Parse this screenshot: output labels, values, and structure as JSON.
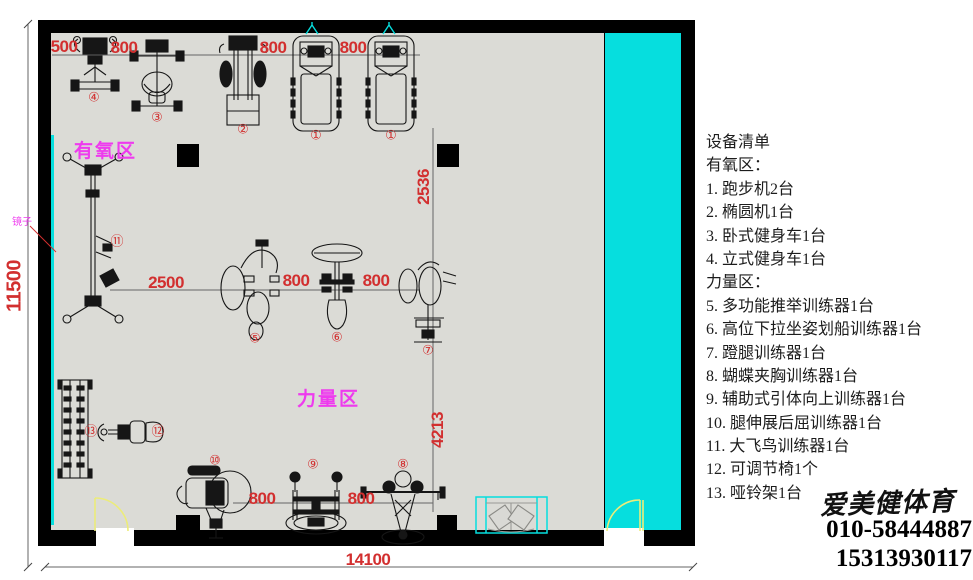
{
  "plan": {
    "zone_labels": {
      "aerobic": "有氧区",
      "strength": "力量区",
      "mirror": "镜子"
    },
    "dims": {
      "top_offset": "500",
      "top_gap1": "800",
      "top_gap2": "800",
      "top_gap3": "800",
      "mid_span": "2500",
      "mid_gap1": "800",
      "mid_gap2": "800",
      "vert_upper": "2536",
      "vert_lower": "4213",
      "bottom_gap1": "800",
      "bottom_gap2": "800",
      "total_height": "11500",
      "total_width": "14100"
    },
    "markers": {
      "m1a": "①",
      "m1b": "①",
      "m2": "②",
      "m3": "③",
      "m4": "④",
      "m5": "⑤",
      "m6": "⑥",
      "m7": "⑦",
      "m8": "⑧",
      "m9": "⑨",
      "m10": "⑩",
      "m11": "⑪",
      "m12": "⑫",
      "m13": "⑬"
    },
    "colors": {
      "dim_red": "#d22f2f",
      "zone_magenta": "#ee3bee",
      "cyan": "#06dede",
      "floor_gray": "#dbdbd6",
      "door_yellow": "#ecec7a"
    }
  },
  "equipment_list": {
    "title": "设备清单",
    "lines": [
      "有氧区：",
      "1. 跑步机2台",
      "2. 椭圆机1台",
      "3. 卧式健身车1台",
      "4. 立式健身车1台",
      "力量区：",
      "5. 多功能推举训练器1台",
      "6. 高位下拉坐姿划船训练器1台",
      "7. 蹬腿训练器1台",
      "8. 蝴蝶夹胸训练器1台",
      "9. 辅助式引体向上训练器1台",
      "10. 腿伸展后屈训练器1台",
      "11. 大飞鸟训练器1台",
      "12. 可调节椅1个",
      "13. 哑铃架1台"
    ]
  },
  "contact": {
    "brand": "爱美健体育",
    "phone_1": "010-58444887",
    "phone_2": "15313930117"
  }
}
